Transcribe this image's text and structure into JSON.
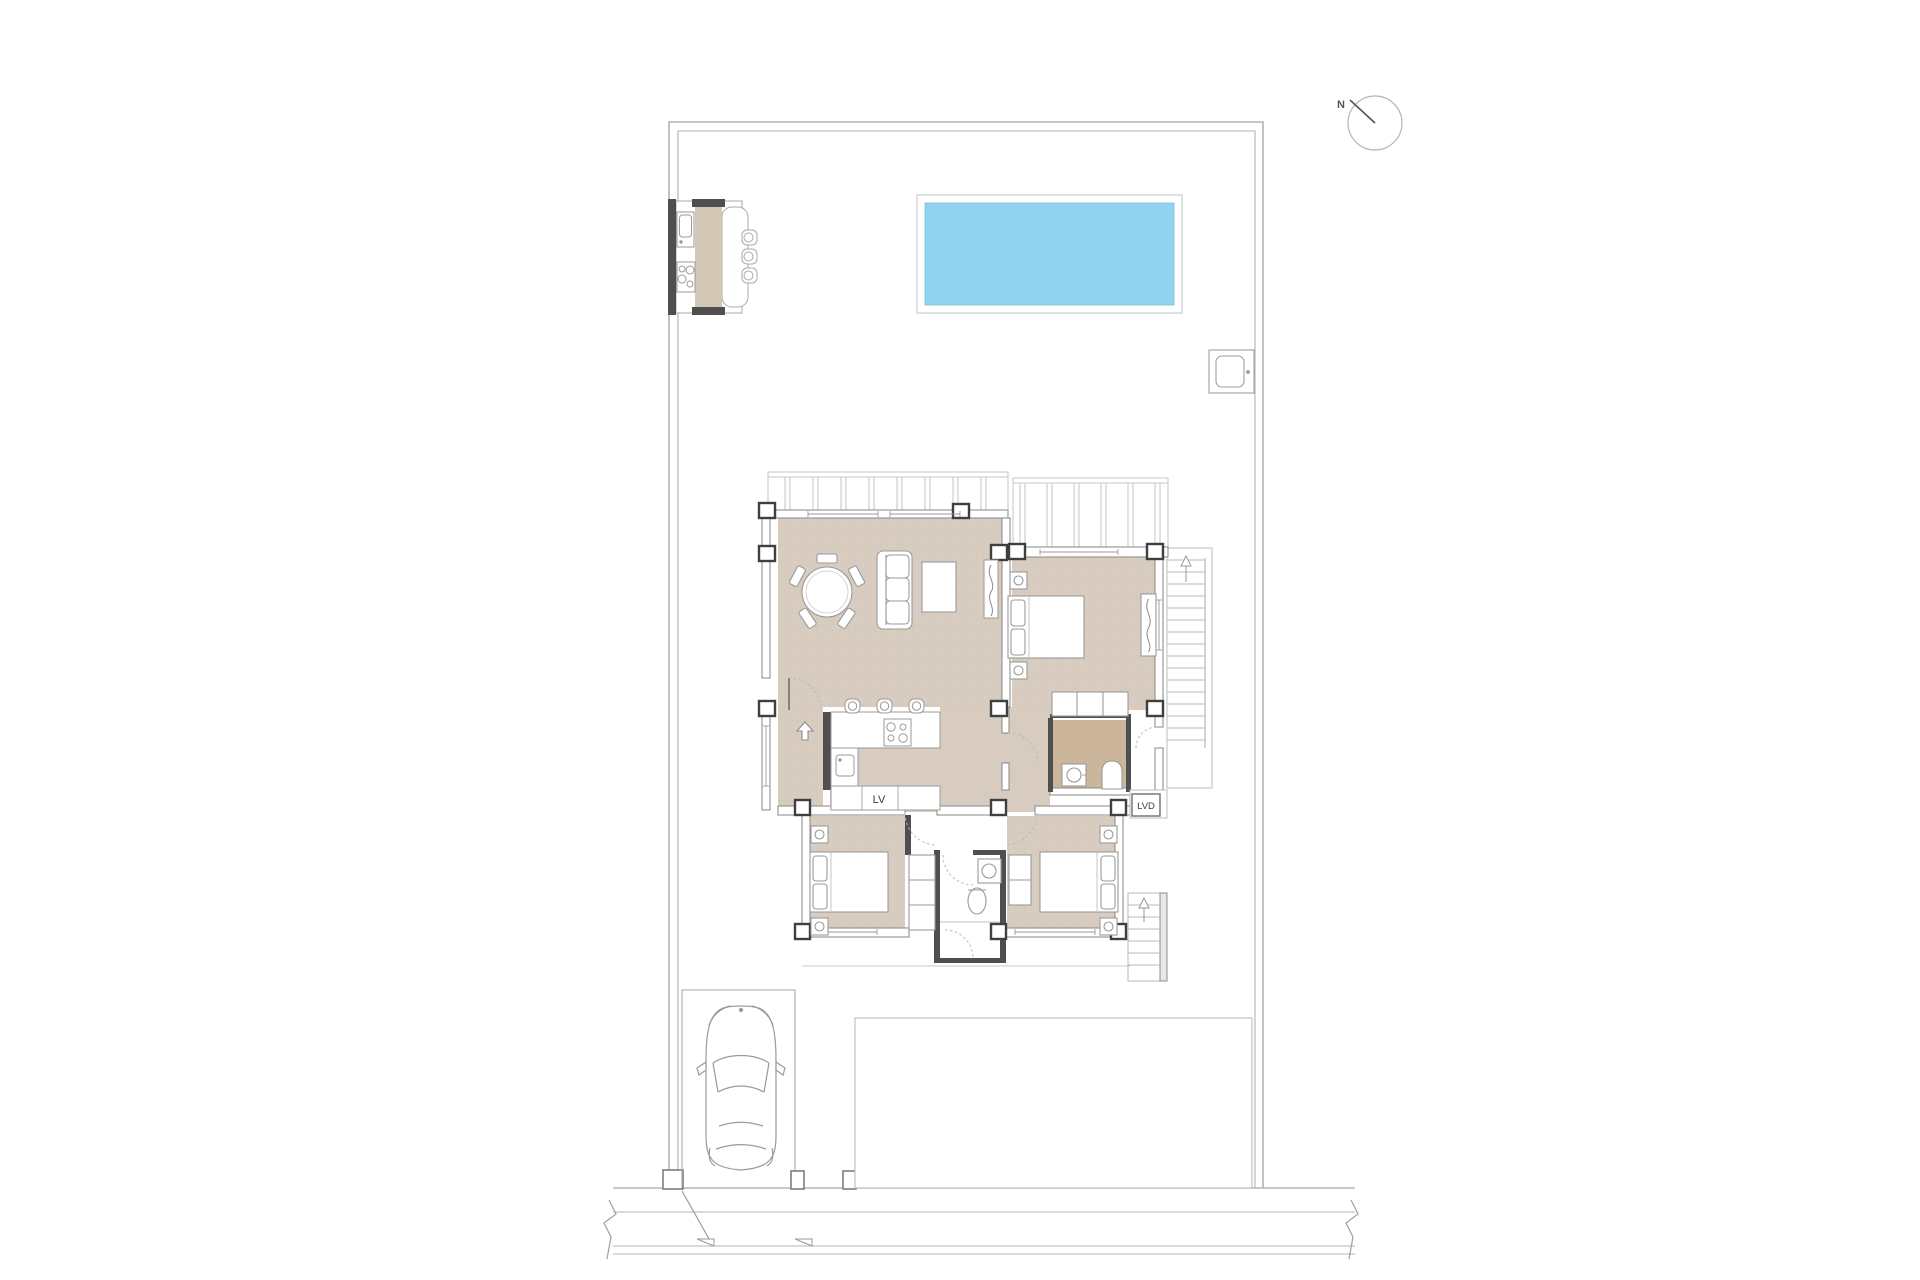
{
  "title": "Villa ground floor site plan",
  "labels": {
    "dishwasher": "LV",
    "laundry": "LVD",
    "north": "N"
  },
  "colors": {
    "floor": "#d7ccbf",
    "bath_floor": "#cbb69c",
    "pool_water": "#90d3ee",
    "counter_bar": "#d3c7b6",
    "wall_dark": "#4a4a4a",
    "wall_light": "#9a9a9a",
    "line_light": "#c2c2c2"
  },
  "compass": {
    "needle_direction": "north-west"
  },
  "site": {
    "features": [
      "plot boundary",
      "swimming pool",
      "outdoor kitchen with bar and 3 stools",
      "air-conditioning unit",
      "parking space with car",
      "terrace patio",
      "street with entrance gates",
      "external stair upper",
      "external stair lower",
      "pergola over living room",
      "pergola over master bedroom"
    ]
  },
  "rooms": [
    {
      "name": "living-dining room",
      "furniture": [
        "round dining table with 5 chairs",
        "3-seat sofa",
        "coffee table",
        "wardrobe"
      ]
    },
    {
      "name": "kitchen",
      "furniture": [
        "L-shaped counter",
        "4-burner cooktop",
        "sink",
        "dishwasher LV",
        "3 bar stools"
      ]
    },
    {
      "name": "master bedroom",
      "furniture": [
        "double bed",
        "2 nightstands with lamps",
        "wardrobe",
        "closet row"
      ]
    },
    {
      "name": "en-suite bathroom",
      "furniture": [
        "washbasin",
        "toilet"
      ]
    },
    {
      "name": "bedroom 2",
      "furniture": [
        "double bed",
        "2 nightstands with lamps",
        "wardrobe"
      ]
    },
    {
      "name": "bedroom 3",
      "furniture": [
        "double bed",
        "2 nightstands with lamps",
        "wardrobe"
      ]
    },
    {
      "name": "bathroom 2",
      "furniture": [
        "washbasin",
        "toilet",
        "shower"
      ]
    },
    {
      "name": "laundry nook",
      "furniture": [
        "washing machine LVD"
      ]
    }
  ]
}
